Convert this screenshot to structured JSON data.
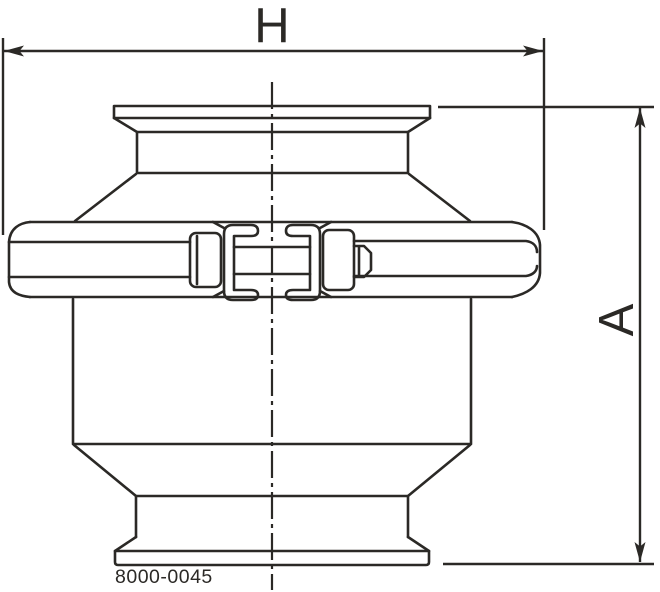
{
  "drawing": {
    "h_label": "H",
    "a_label": "A",
    "part_number": "8000-0045",
    "line_color": "#2b2926",
    "background_color": "#ffffff"
  }
}
